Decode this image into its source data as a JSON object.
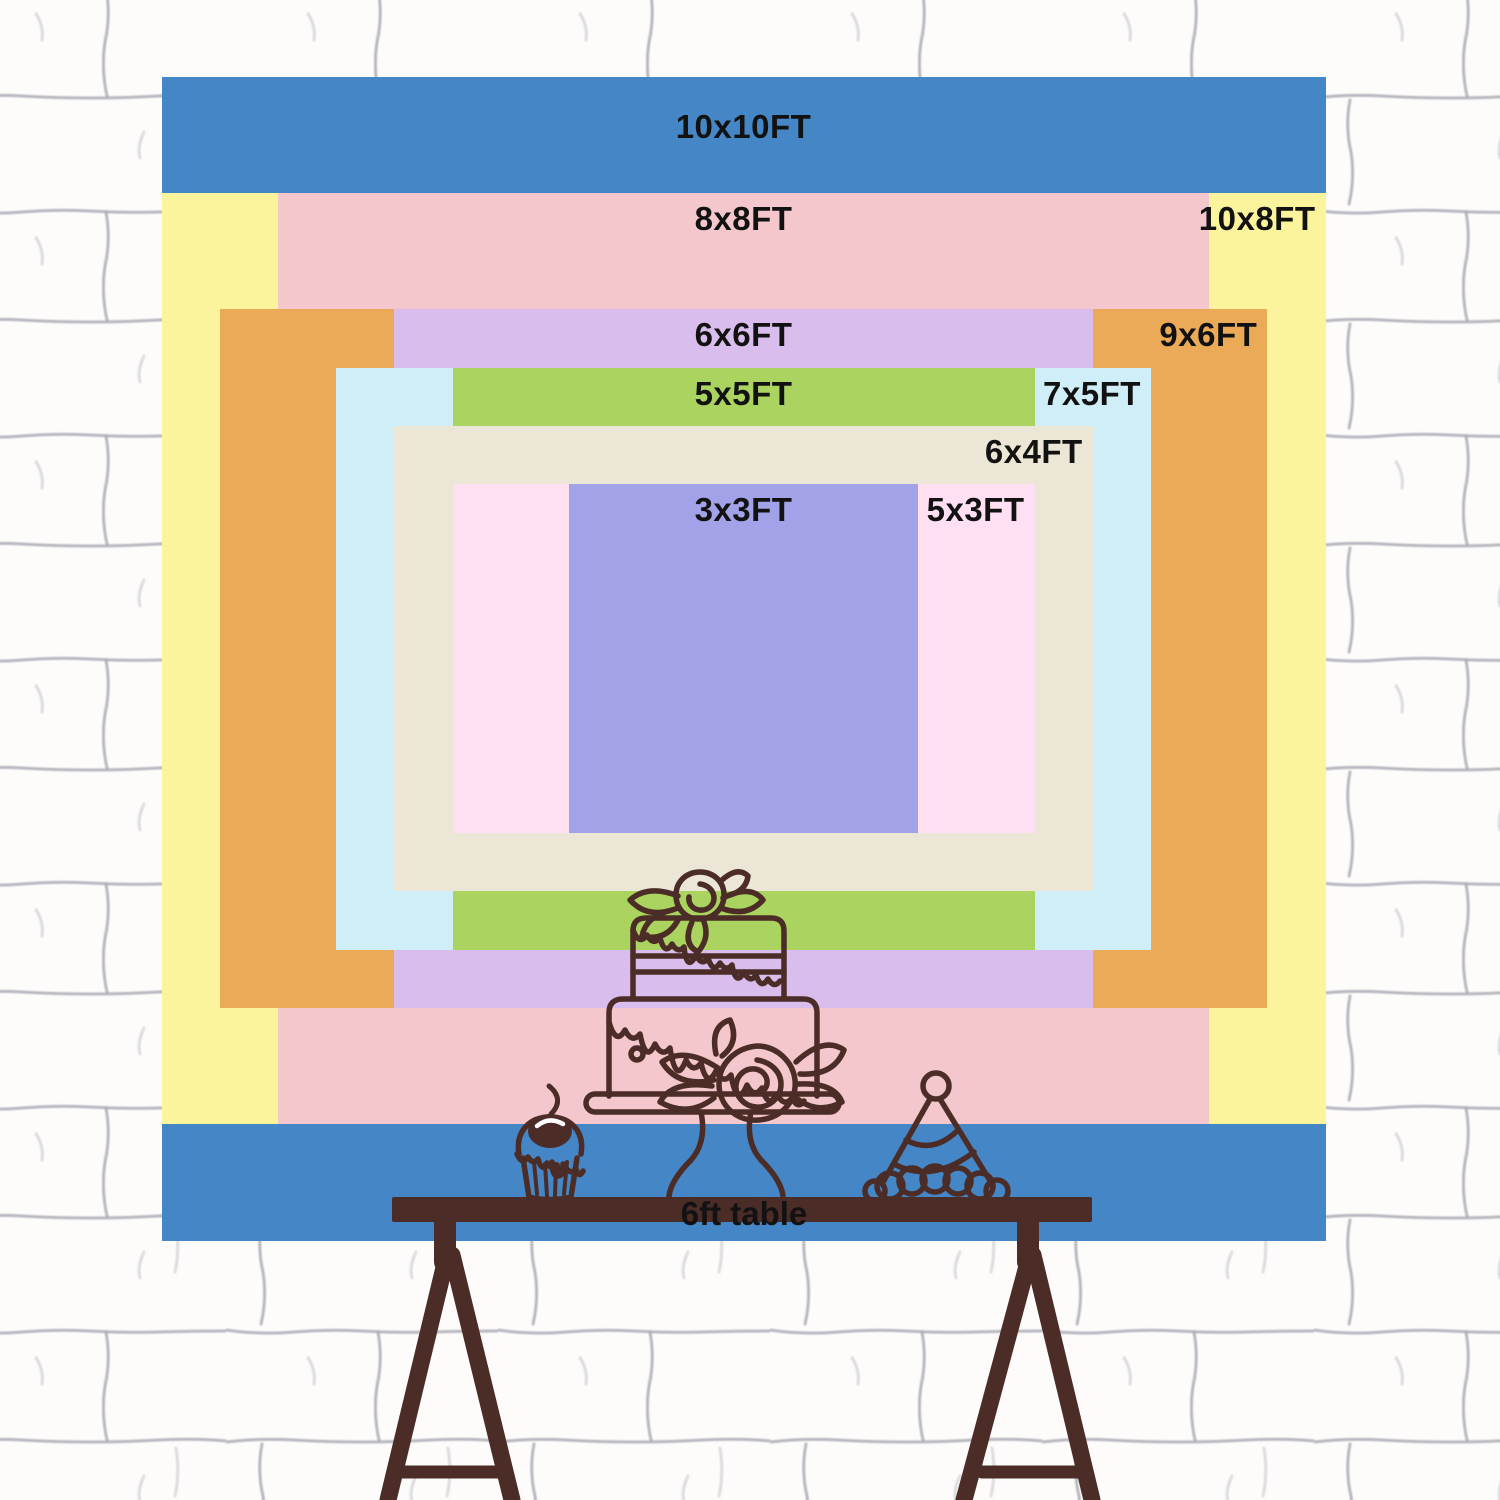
{
  "page": {
    "description": "Backdrop size comparison chart on a white brick wall",
    "wall_color": "#fdfcfa",
    "mortar_color": "#a6a6b2",
    "label_color": "#121212",
    "line_color": "#4b2c26",
    "px_per_ft": 116.4
  },
  "backdrop": {
    "sizes": [
      {
        "id": "10x10ft",
        "label": "10x10FT",
        "color": "#4587c6",
        "w_ft": 10,
        "h_ft": 10,
        "label_pos": "top-center"
      },
      {
        "id": "10x8ft",
        "label": "10x8FT",
        "color": "#fbf49c",
        "w_ft": 10,
        "h_ft": 8,
        "label_pos": "top-right"
      },
      {
        "id": "8x8ft",
        "label": "8x8FT",
        "color": "#f3c7cb",
        "w_ft": 8,
        "h_ft": 8,
        "label_pos": "top-center"
      },
      {
        "id": "9x6ft",
        "label": "9x6FT",
        "color": "#ebaa57",
        "w_ft": 9,
        "h_ft": 6,
        "label_pos": "top-right"
      },
      {
        "id": "6x6ft",
        "label": "6x6FT",
        "color": "#d9bdec",
        "w_ft": 6,
        "h_ft": 6,
        "label_pos": "top-center"
      },
      {
        "id": "7x5ft",
        "label": "7x5FT",
        "color": "#cfeef8",
        "w_ft": 7,
        "h_ft": 5,
        "label_pos": "top-right"
      },
      {
        "id": "5x5ft",
        "label": "5x5FT",
        "color": "#aad35f",
        "w_ft": 5,
        "h_ft": 5,
        "label_pos": "top-center"
      },
      {
        "id": "6x4ft",
        "label": "6x4FT",
        "color": "#ebe6d5",
        "w_ft": 6,
        "h_ft": 4,
        "label_pos": "top-right"
      },
      {
        "id": "5x3ft",
        "label": "5x3FT",
        "color": "#fee0f2",
        "w_ft": 5,
        "h_ft": 3,
        "label_pos": "top-right"
      },
      {
        "id": "3x3ft",
        "label": "3x3FT",
        "color": "#a2a2e8",
        "w_ft": 3,
        "h_ft": 3,
        "label_pos": "top-center"
      }
    ]
  },
  "table": {
    "label": "6ft table",
    "color": "#4b2c26",
    "width_ft": 6
  },
  "illustrations": [
    {
      "name": "birthday-cake"
    },
    {
      "name": "cupcake"
    },
    {
      "name": "party-hat"
    }
  ]
}
